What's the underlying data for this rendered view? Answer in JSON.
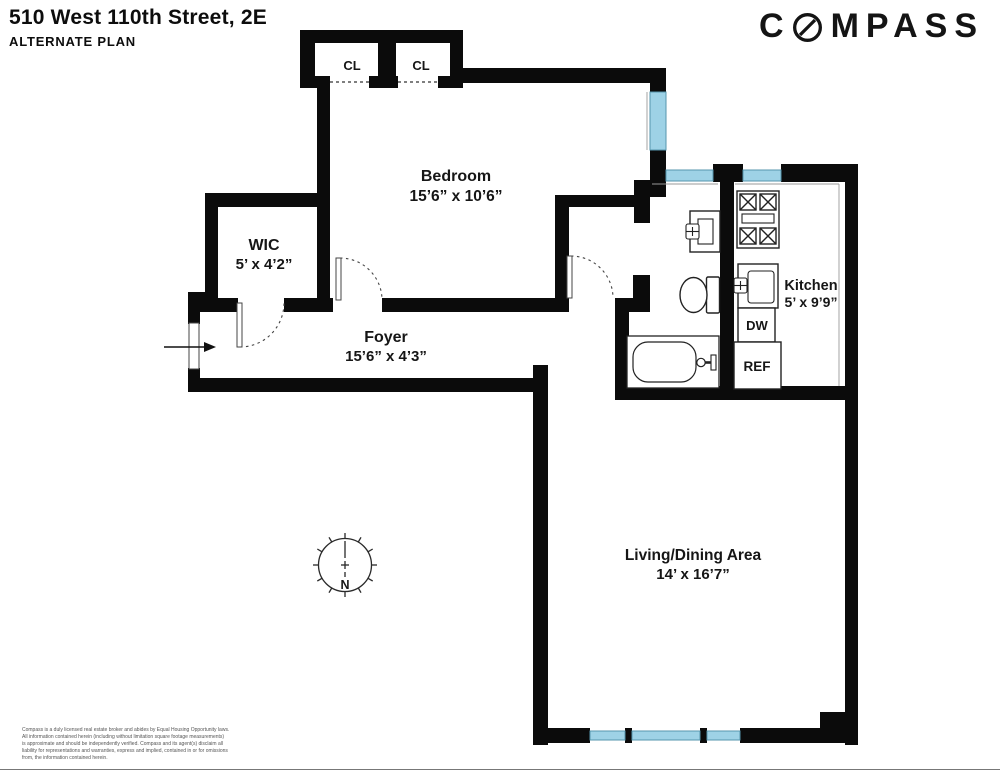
{
  "header": {
    "address": "510 West 110th Street, 2E",
    "plan_type": "ALTERNATE PLAN"
  },
  "logo": {
    "brand": "COMPASS",
    "prefix": "C",
    "suffix": "MPASS"
  },
  "rooms": {
    "bedroom": {
      "name": "Bedroom",
      "dims": "15’6” x 10’6”"
    },
    "wic": {
      "name": "WIC",
      "dims": "5’ x 4’2”"
    },
    "foyer": {
      "name": "Foyer",
      "dims": "15’6” x 4’3”"
    },
    "kitchen": {
      "name": "Kitchen",
      "dims": "5’ x 9’9”"
    },
    "living": {
      "name": "Living/Dining Area",
      "dims": "14’ x 16’7”"
    },
    "closet_left": {
      "name": "CL"
    },
    "closet_right": {
      "name": "CL"
    }
  },
  "appliances": {
    "dishwasher": "DW",
    "refrigerator": "REF"
  },
  "compass_rose": {
    "north": "N"
  },
  "colors": {
    "wall": "#0b0b0b",
    "window_fill": "#9ed2e6",
    "window_stroke": "#5596ad"
  },
  "disclaimer": {
    "lines": [
      "Compass is a duly licensed real estate broker and abides by Equal Housing Opportunity laws.",
      "All information contained herein (including without limitation square footage measurements)",
      " is approximate and should be independently verified. Compass and its agent(s) disclaim all",
      "liability for representations and warranties, express and implied, contained in or for omissions",
      " from, the information contained herein."
    ]
  }
}
